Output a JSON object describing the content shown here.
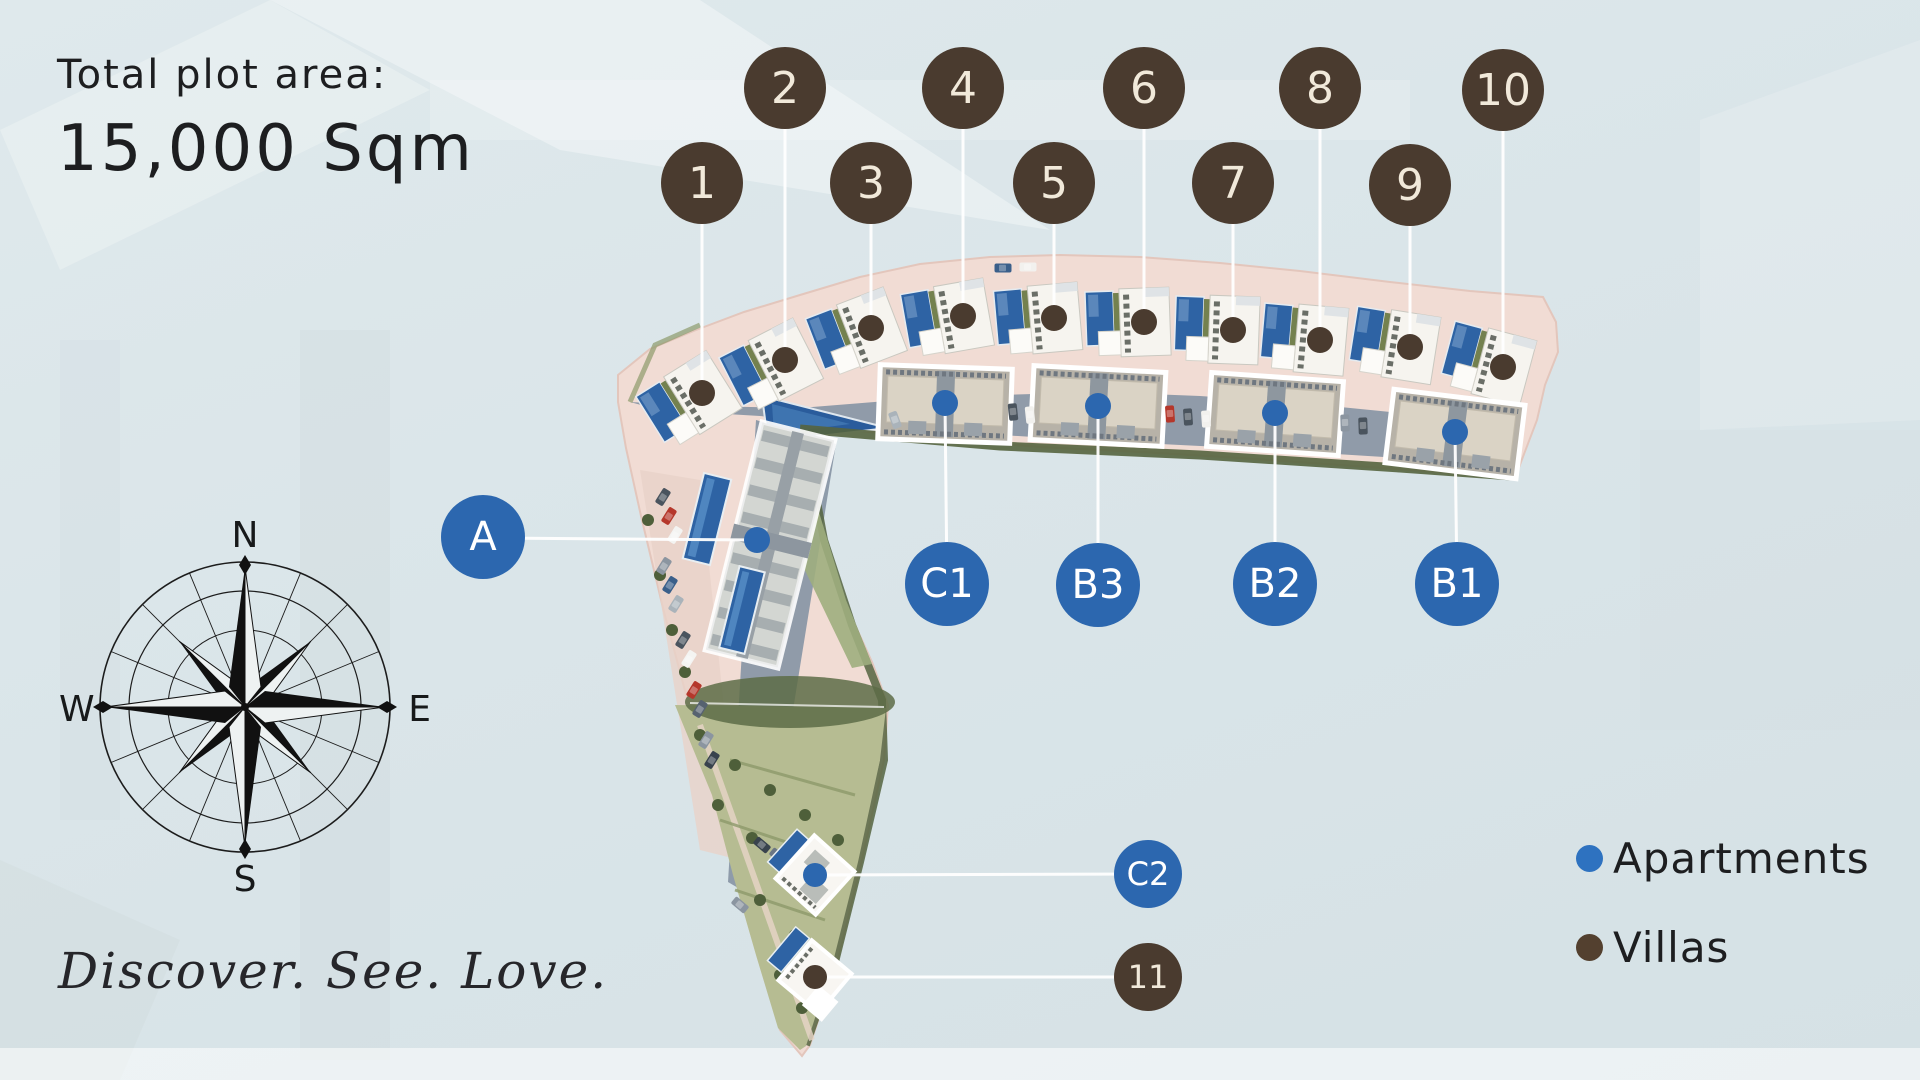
{
  "title": {
    "line1": "Total plot area:",
    "line2": "15,000 Sqm"
  },
  "tagline": "Discover. See. Love.",
  "compass": {
    "n": "N",
    "e": "E",
    "s": "S",
    "w": "W"
  },
  "legend": {
    "apartments_label": "Apartments",
    "villas_label": "Villas",
    "apartment_color": "#2e72c0",
    "villa_color": "#53402f"
  },
  "markers": {
    "villas": [
      {
        "label": "1"
      },
      {
        "label": "2"
      },
      {
        "label": "3"
      },
      {
        "label": "4"
      },
      {
        "label": "5"
      },
      {
        "label": "6"
      },
      {
        "label": "7"
      },
      {
        "label": "8"
      },
      {
        "label": "9"
      },
      {
        "label": "10"
      },
      {
        "label": "11"
      }
    ],
    "apartments": [
      {
        "label": "A"
      },
      {
        "label": "C1"
      },
      {
        "label": "B3"
      },
      {
        "label": "B2"
      },
      {
        "label": "B1"
      },
      {
        "label": "C2"
      }
    ]
  },
  "colors": {
    "villa_marker": "#4a3b2f",
    "apartment_marker": "#2c67af",
    "sand": "#f1dcd4",
    "road": "#8a97a6",
    "pool": "#2e63a4",
    "background": "#dce6ea"
  }
}
